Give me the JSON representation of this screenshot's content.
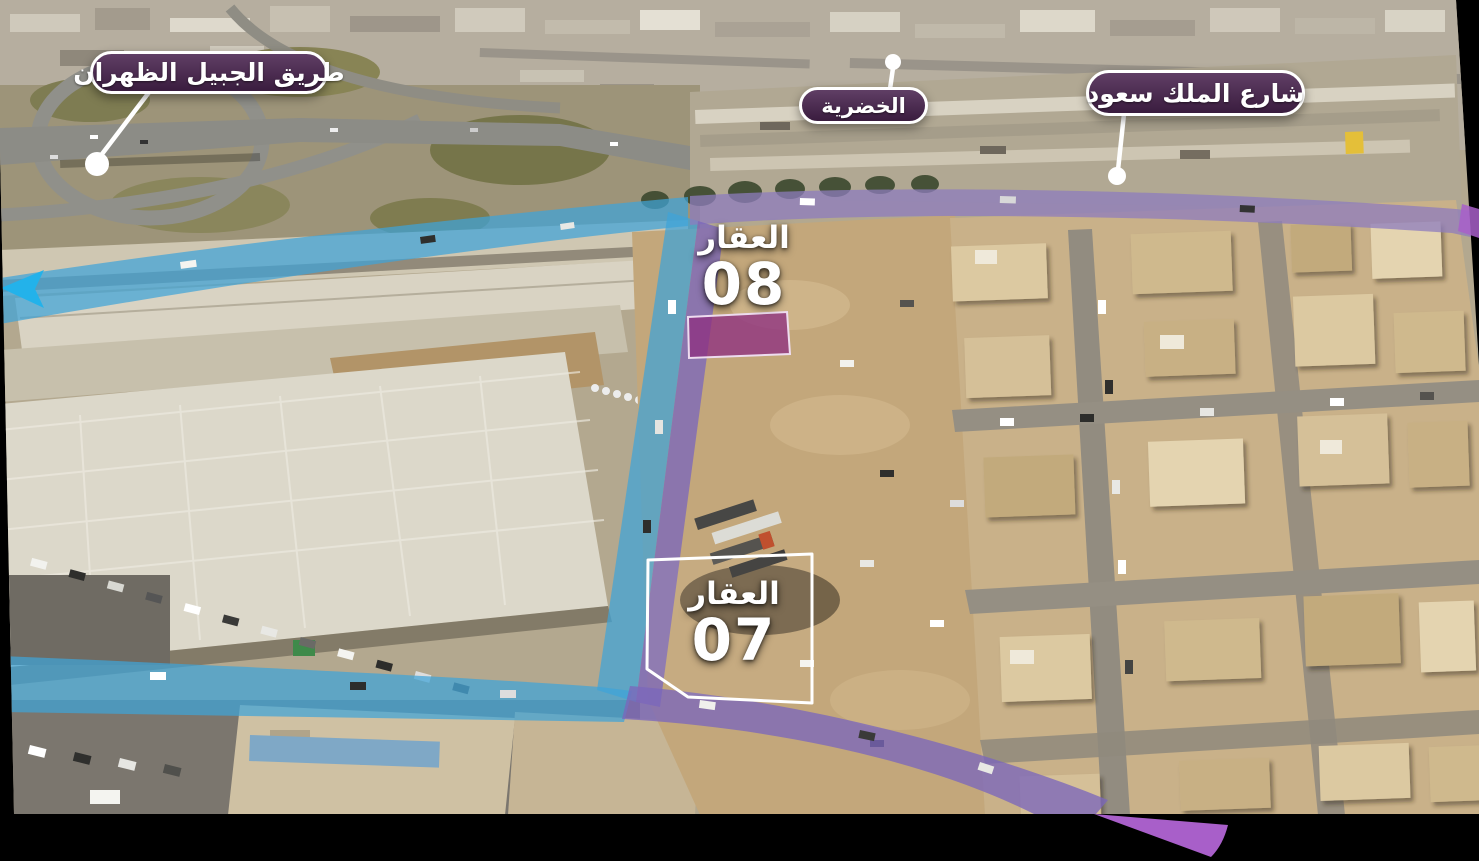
{
  "canvas": {
    "width": 1479,
    "height": 861,
    "background": "#000000"
  },
  "callouts": [
    {
      "id": "jubail-dhahran-road",
      "label": "طريق الجبيل الظهران"
    },
    {
      "id": "al-khudariyah",
      "label": "الخضرية"
    },
    {
      "id": "king-saud-street",
      "label": "شارع الملك سعود"
    }
  ],
  "properties": [
    {
      "id": "property-08",
      "label": "العقار",
      "number": "08"
    },
    {
      "id": "property-07",
      "label": "العقار",
      "number": "07"
    }
  ],
  "colors": {
    "road-blue": "#3fa3d8",
    "arrow-blue": "#23b2ea",
    "road-purple": "#7b67bb",
    "road-purple-top": "#8d7cbd",
    "plot": "#8e2f80",
    "swoosh": "#a85fc9",
    "pill": "#4a2450",
    "pill-border": "#ffffff",
    "label-text": "#ffffff"
  }
}
